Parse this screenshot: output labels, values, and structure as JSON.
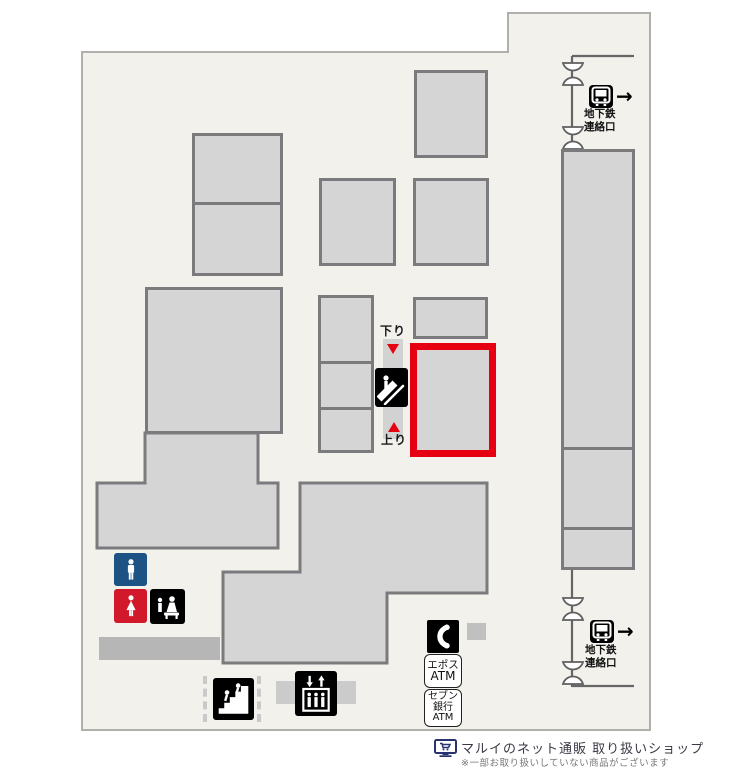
{
  "colors": {
    "floor_bg": "#f2f1ec",
    "floor_border": "#b0afab",
    "block_fill": "#d5d5d6",
    "block_border": "#7b7b7e",
    "highlight_red": "#e60012",
    "mens_blue": "#1c5384",
    "womens_red": "#d2192b",
    "icon_black": "#000000",
    "netshop_navy": "#283271"
  },
  "escalator": {
    "down_label": "下り",
    "up_label": "上り"
  },
  "subway_entrance": {
    "label_line1": "地下鉄",
    "label_line2": "連絡口",
    "arrow": "→"
  },
  "atm_epos": {
    "line1": "エポス",
    "line2": "ATM"
  },
  "atm_seven_bank": {
    "line1": "セブン",
    "line2": "銀行",
    "line3": "ATM"
  },
  "legend": {
    "title": "マルイのネット通販 取り扱いショップ",
    "note": "※一部お取り扱いしていない商品がございます"
  },
  "icons": {
    "escalator": "escalator-icon",
    "stairs": "stairs-icon",
    "elevator": "elevator-icon",
    "phone": "phone-icon",
    "mens_toilet": "mens-toilet-icon",
    "womens_toilet": "womens-toilet-icon",
    "baby_care": "baby-care-icon",
    "train": "train-icon",
    "entrance_gate": "entrance-gate-icon",
    "net_shop": "net-shop-icon"
  }
}
